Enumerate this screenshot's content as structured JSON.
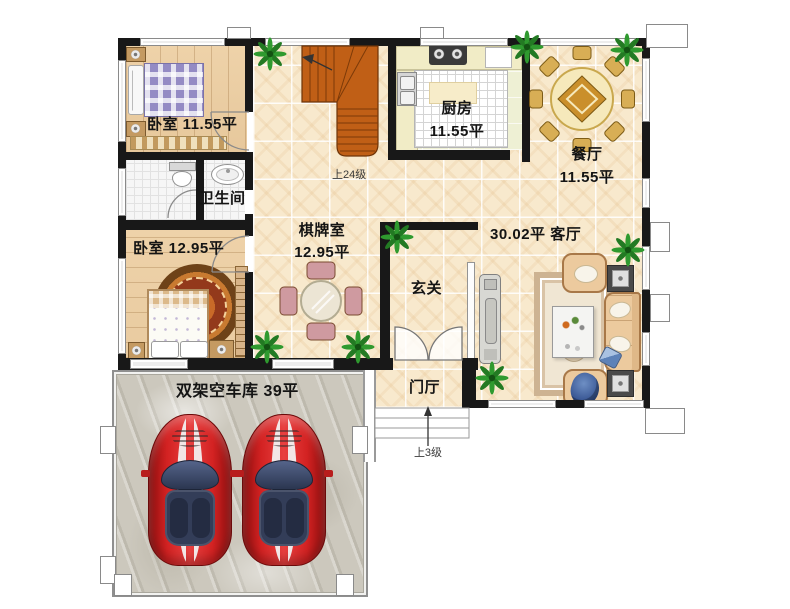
{
  "type": "residential_floor_plan",
  "labels": {
    "bedroom1": "卧室 11.55平",
    "bathroom": "卫生间",
    "bedroom2": "卧室 12.95平",
    "kitchen_name": "厨房",
    "kitchen_area": "11.55平",
    "dining_name": "餐厅",
    "dining_area": "11.55平",
    "chess_name": "棋牌室",
    "chess_area": "12.95平",
    "living": "30.02平 客厅",
    "entry": "玄关",
    "foyer": "门厅",
    "garage": "双架空车库  39平",
    "stairs_note": "上24级",
    "steps_note": "上3级"
  },
  "colors": {
    "wall": "#181818",
    "tile_floor": "#f8e9cd",
    "wood_floor": "#ebcfa6",
    "kitchen_floor": "#eef0d4",
    "bath_floor": "#f6f6f6",
    "garage_floor": "#ccc8bd",
    "stairs": "#c05f16",
    "car": "#d32222",
    "plant": "#2f9a2f",
    "dining_table": "#f6e9bb",
    "sofa": "#ecca9e"
  },
  "structure": {
    "walls": [
      [
        118,
        38,
        532,
        8
      ],
      [
        118,
        46,
        8,
        324
      ],
      [
        245,
        46,
        8,
        66
      ],
      [
        118,
        152,
        135,
        8
      ],
      [
        196,
        160,
        8,
        60
      ],
      [
        118,
        220,
        135,
        10
      ],
      [
        245,
        160,
        8,
        30
      ],
      [
        245,
        214,
        8,
        22
      ],
      [
        245,
        272,
        8,
        86
      ],
      [
        118,
        358,
        275,
        12
      ],
      [
        462,
        358,
        16,
        12
      ],
      [
        388,
        38,
        8,
        122
      ],
      [
        388,
        150,
        122,
        10
      ],
      [
        522,
        38,
        8,
        124
      ],
      [
        380,
        222,
        98,
        8
      ],
      [
        380,
        222,
        10,
        136
      ],
      [
        462,
        358,
        14,
        50
      ],
      [
        462,
        400,
        188,
        8
      ],
      [
        642,
        38,
        8,
        370
      ]
    ],
    "windows": [
      [
        140,
        38,
        85,
        8
      ],
      [
        265,
        38,
        85,
        8
      ],
      [
        420,
        38,
        88,
        8
      ],
      [
        540,
        38,
        96,
        8
      ],
      [
        118,
        60,
        8,
        82
      ],
      [
        118,
        168,
        8,
        48
      ],
      [
        118,
        258,
        8,
        96
      ],
      [
        642,
        58,
        8,
        64
      ],
      [
        642,
        178,
        8,
        30
      ],
      [
        642,
        246,
        8,
        44
      ],
      [
        642,
        332,
        8,
        34
      ],
      [
        130,
        359,
        58,
        10
      ],
      [
        272,
        359,
        62,
        10
      ],
      [
        488,
        400,
        68,
        8
      ],
      [
        584,
        400,
        60,
        8
      ]
    ],
    "columns": [
      [
        227,
        27,
        24,
        12
      ],
      [
        420,
        27,
        24,
        12
      ],
      [
        646,
        24,
        42,
        24
      ],
      [
        650,
        222,
        20,
        30
      ],
      [
        650,
        294,
        20,
        28
      ],
      [
        645,
        408,
        40,
        26
      ],
      [
        100,
        426,
        16,
        28
      ],
      [
        100,
        556,
        16,
        28
      ],
      [
        352,
        426,
        16,
        28
      ],
      [
        114,
        574,
        18,
        22
      ],
      [
        336,
        574,
        18,
        22
      ]
    ]
  },
  "decor": {
    "plants": [
      [
        270,
        54
      ],
      [
        527,
        47
      ],
      [
        627,
        50
      ],
      [
        397,
        237
      ],
      [
        267,
        347
      ],
      [
        358,
        347
      ],
      [
        628,
        250
      ],
      [
        492,
        378
      ]
    ],
    "cars": [
      [
        148,
        414
      ],
      [
        242,
        414
      ]
    ],
    "dining_chair_angles": [
      0,
      45,
      90,
      135,
      180,
      225,
      270,
      315
    ]
  }
}
